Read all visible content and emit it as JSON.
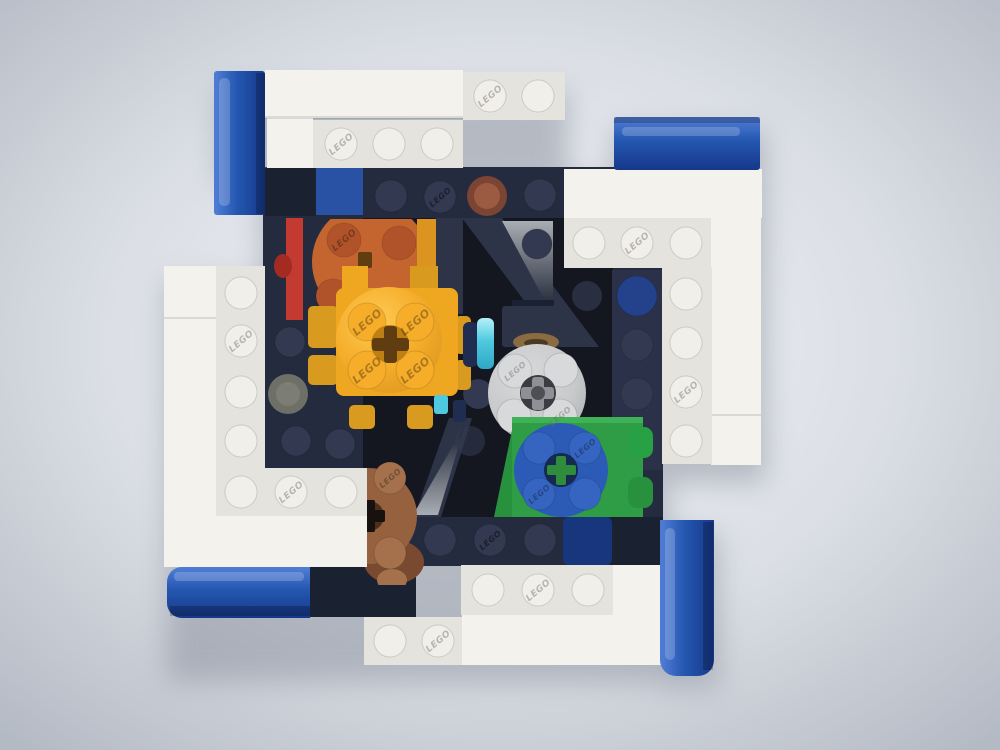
{
  "stud_logo": "LEGO",
  "colors": {
    "bg_center": "#F3F5F8",
    "bg_mid": "#DBDFE5",
    "bg_edge": "#B4BAC4",
    "shadow": "#878E9B",
    "white_top": "#F4F2ED",
    "white_plate": "#E5E3DE",
    "white_stud": "#F1EFEA",
    "blue": "#2457B0",
    "blue_dark": "#16388A",
    "blue_light": "#4D7AD2",
    "navy_plate": "#242B3E",
    "navy_dark": "#1A2130",
    "navy_stud": "#323950",
    "navy_column": "#2A3149",
    "inner_black": "#14171F",
    "beam": "#2D3447",
    "tri_light": "#A9ADB4",
    "tri_dark": "#222938",
    "red": "#C33A30",
    "red_dark": "#A42B22",
    "orange": "#C4652F",
    "orange_stud": "#B0532A",
    "yellow": "#F5AD2A",
    "yellow_light": "#FFCB55",
    "yellow_shade": "#DC9420",
    "yellow_mid": "#EFA722",
    "yellow_tab": "#D99B1F",
    "axle_socket": "#C07F12",
    "axle_brown": "#5F3D10",
    "gray": "#C9CACC",
    "gray_stud": "#D8D9DB",
    "gray_dark": "#AEAFB3",
    "gray_axle": "#8E9095",
    "gray_axle_bg": "#3A3C41",
    "green": "#2F9D45",
    "green_dark": "#28913D",
    "green_top": "#3FB156",
    "green_tab": "#27A143",
    "green_cross": "#2F8C3C",
    "blue_round": "#2B5BB7",
    "blue_round_stud": "#3565C0",
    "blue_hole": "#16294F",
    "brown": "#96613F",
    "brown_stud": "#A4714C",
    "brown_side": "#7A4A30",
    "brown_axle_bg": "#4E2F1B",
    "brown_axle": "#17120D",
    "brown1x1_outer": "#7C4433",
    "brown1x1_inner": "#9A5B42",
    "blue1x1": "#2A52A4",
    "blue_stud_dark": "#24418C",
    "teal": "#4FC9E0",
    "teal_light": "#B5F1F8",
    "teal_dark": "#2FA8C4",
    "pin_navy": "#202C50",
    "gold": "#8A6B42",
    "gold_dark": "#4A3A22",
    "gray1x1": "#6E7068",
    "gray1x1_inner": "#7C7E74",
    "logo_dark": "rgba(0,0,0,0.30)",
    "logo_gray": "rgba(115,110,100,0.45)",
    "logo_navy": "rgba(0,0,0,0.45)"
  }
}
